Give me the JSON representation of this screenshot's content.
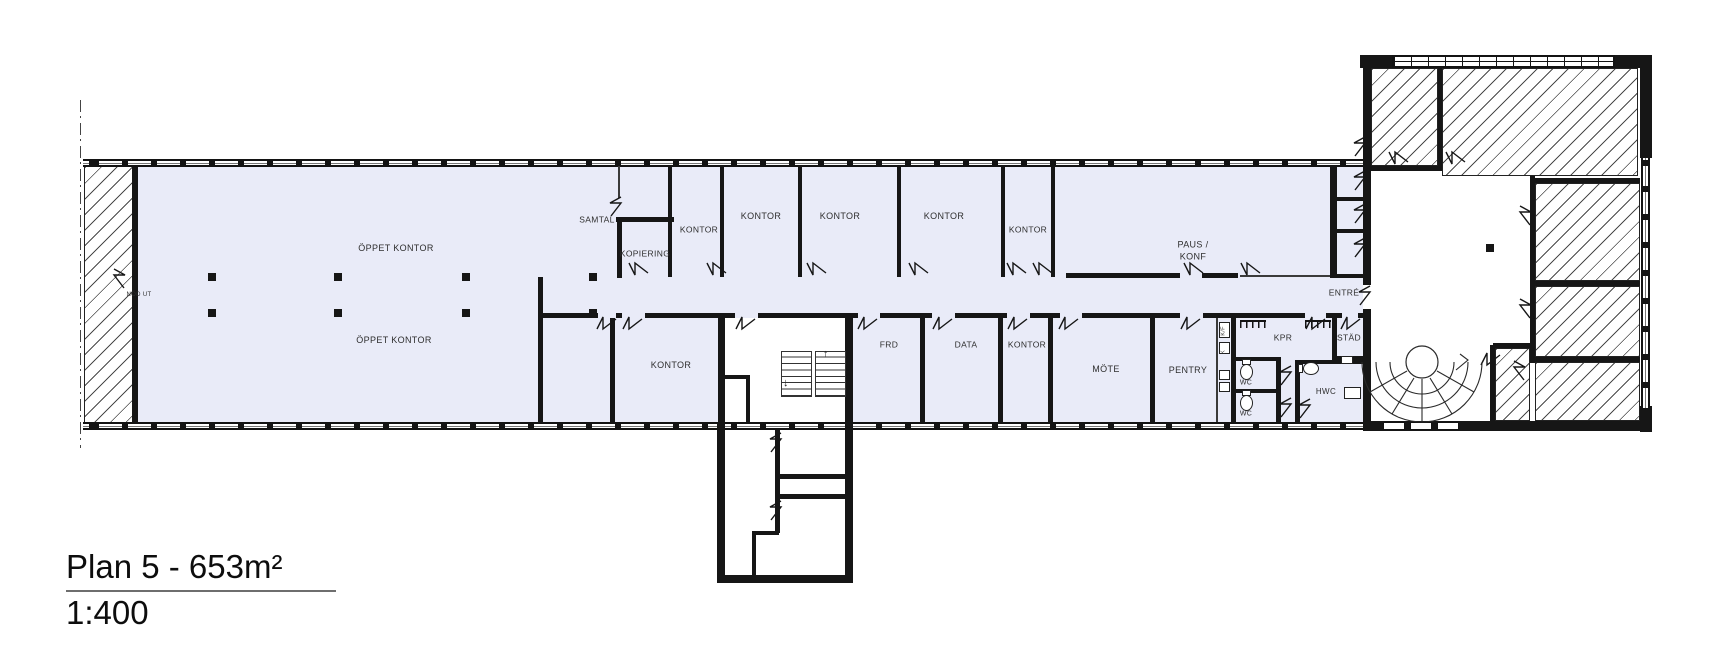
{
  "plan": {
    "title": "Plan 5 - 653m²",
    "scale": "1:400"
  },
  "colors": {
    "floor_fill": "#e9ebf8",
    "wall": "#161616",
    "hatch_line": "#4a4a4a",
    "label_text": "#2e2e2e"
  },
  "rooms": [
    {
      "label": "ÖPPET KONTOR",
      "x": 396,
      "y": 249
    },
    {
      "label": "ÖPPET KONTOR",
      "x": 394,
      "y": 341
    },
    {
      "label": "NÖD UT",
      "x": 139,
      "y": 296,
      "fs": 6
    },
    {
      "label": "SAMTAL",
      "x": 597,
      "y": 220,
      "fs": 8.5
    },
    {
      "label": "KOPIERING",
      "x": 645,
      "y": 254,
      "fs": 8.5
    },
    {
      "label": "KONTOR",
      "x": 699,
      "y": 230,
      "fs": 8.5
    },
    {
      "label": "KONTOR",
      "x": 761,
      "y": 217
    },
    {
      "label": "KONTOR",
      "x": 840,
      "y": 217
    },
    {
      "label": "KONTOR",
      "x": 944,
      "y": 217
    },
    {
      "label": "KONTOR",
      "x": 1028,
      "y": 230,
      "fs": 8.5
    },
    {
      "label": "PAUS /\nKONF",
      "x": 1193,
      "y": 251
    },
    {
      "label": "ENTRÉ",
      "x": 1344,
      "y": 293,
      "fs": 8.5
    },
    {
      "label": "KONTOR",
      "x": 671,
      "y": 366
    },
    {
      "label": "FRD",
      "x": 889,
      "y": 345,
      "fs": 8.5
    },
    {
      "label": "DATA",
      "x": 966,
      "y": 345,
      "fs": 8.5
    },
    {
      "label": "KONTOR",
      "x": 1027,
      "y": 345,
      "fs": 8.5
    },
    {
      "label": "MÖTE",
      "x": 1106,
      "y": 370
    },
    {
      "label": "PENTRY",
      "x": 1188,
      "y": 371
    },
    {
      "label": "WC",
      "x": 1246,
      "y": 383,
      "fs": 7
    },
    {
      "label": "WC",
      "x": 1246,
      "y": 414,
      "fs": 7
    },
    {
      "label": "KPR",
      "x": 1283,
      "y": 338,
      "fs": 8.5
    },
    {
      "label": "STÄD",
      "x": 1349,
      "y": 338,
      "fs": 8.5
    },
    {
      "label": "HWC",
      "x": 1326,
      "y": 392,
      "fs": 8
    },
    {
      "label": "K/F",
      "x": 1224,
      "y": 331,
      "fs": 5.5,
      "rot": -90
    },
    {
      "label": "K",
      "x": 1224,
      "y": 352,
      "fs": 5.5,
      "rot": -90
    }
  ]
}
